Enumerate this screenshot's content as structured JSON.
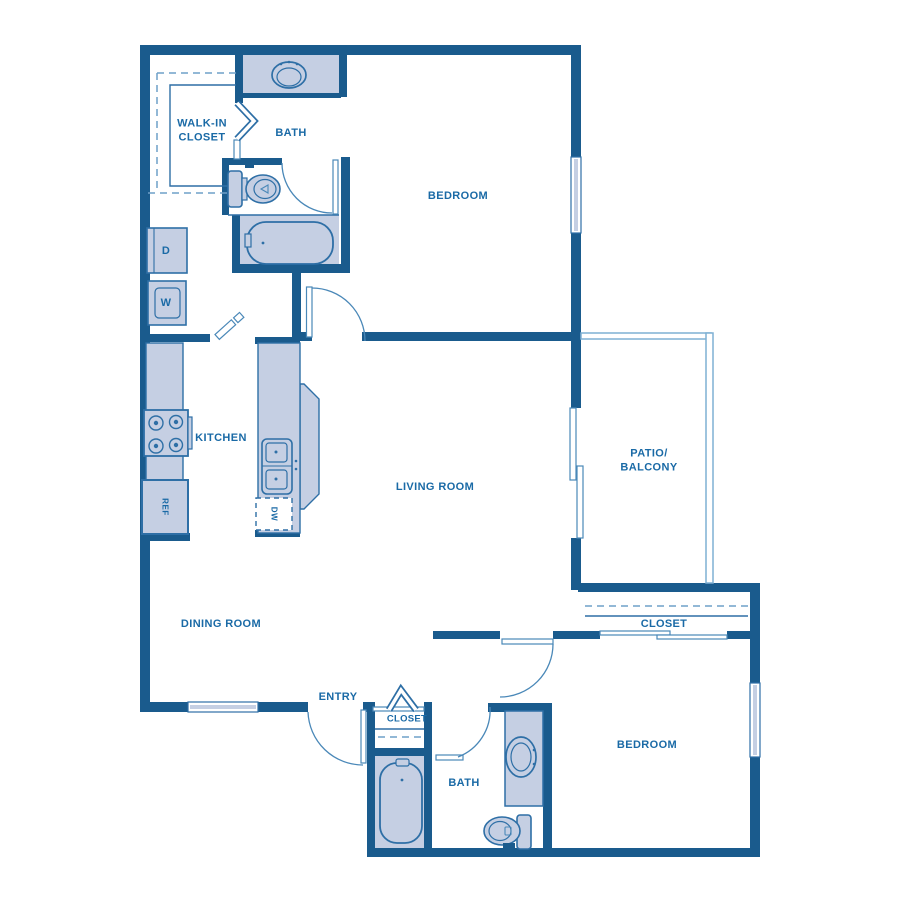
{
  "title": "Two bedroom / two bath apartment floor plan",
  "colors": {
    "wall": "#1a5b8d",
    "fixture_fill": "#c5cfe3",
    "line": "#2e6fa6",
    "arc": "#4a88b8",
    "dashed": "#6fa0c8",
    "patio_line": "#7fb0d4",
    "text": "#1a6aa6",
    "bg": "#ffffff"
  },
  "rooms": {
    "bedroom1": "BEDROOM",
    "bath1": "BATH",
    "walk_in_closet": "WALK-IN CLOSET",
    "kitchen": "KITCHEN",
    "living_room": "LIVING ROOM",
    "dining_room": "DINING ROOM",
    "patio": "PATIO/ BALCONY",
    "entry": "ENTRY",
    "entry_closet": "CLOSET",
    "bath2": "BATH",
    "bedroom2": "BEDROOM",
    "closet2": "CLOSET"
  },
  "appliances": {
    "dryer": "D",
    "washer": "W",
    "refrigerator": "REF",
    "dishwasher": "DW"
  }
}
